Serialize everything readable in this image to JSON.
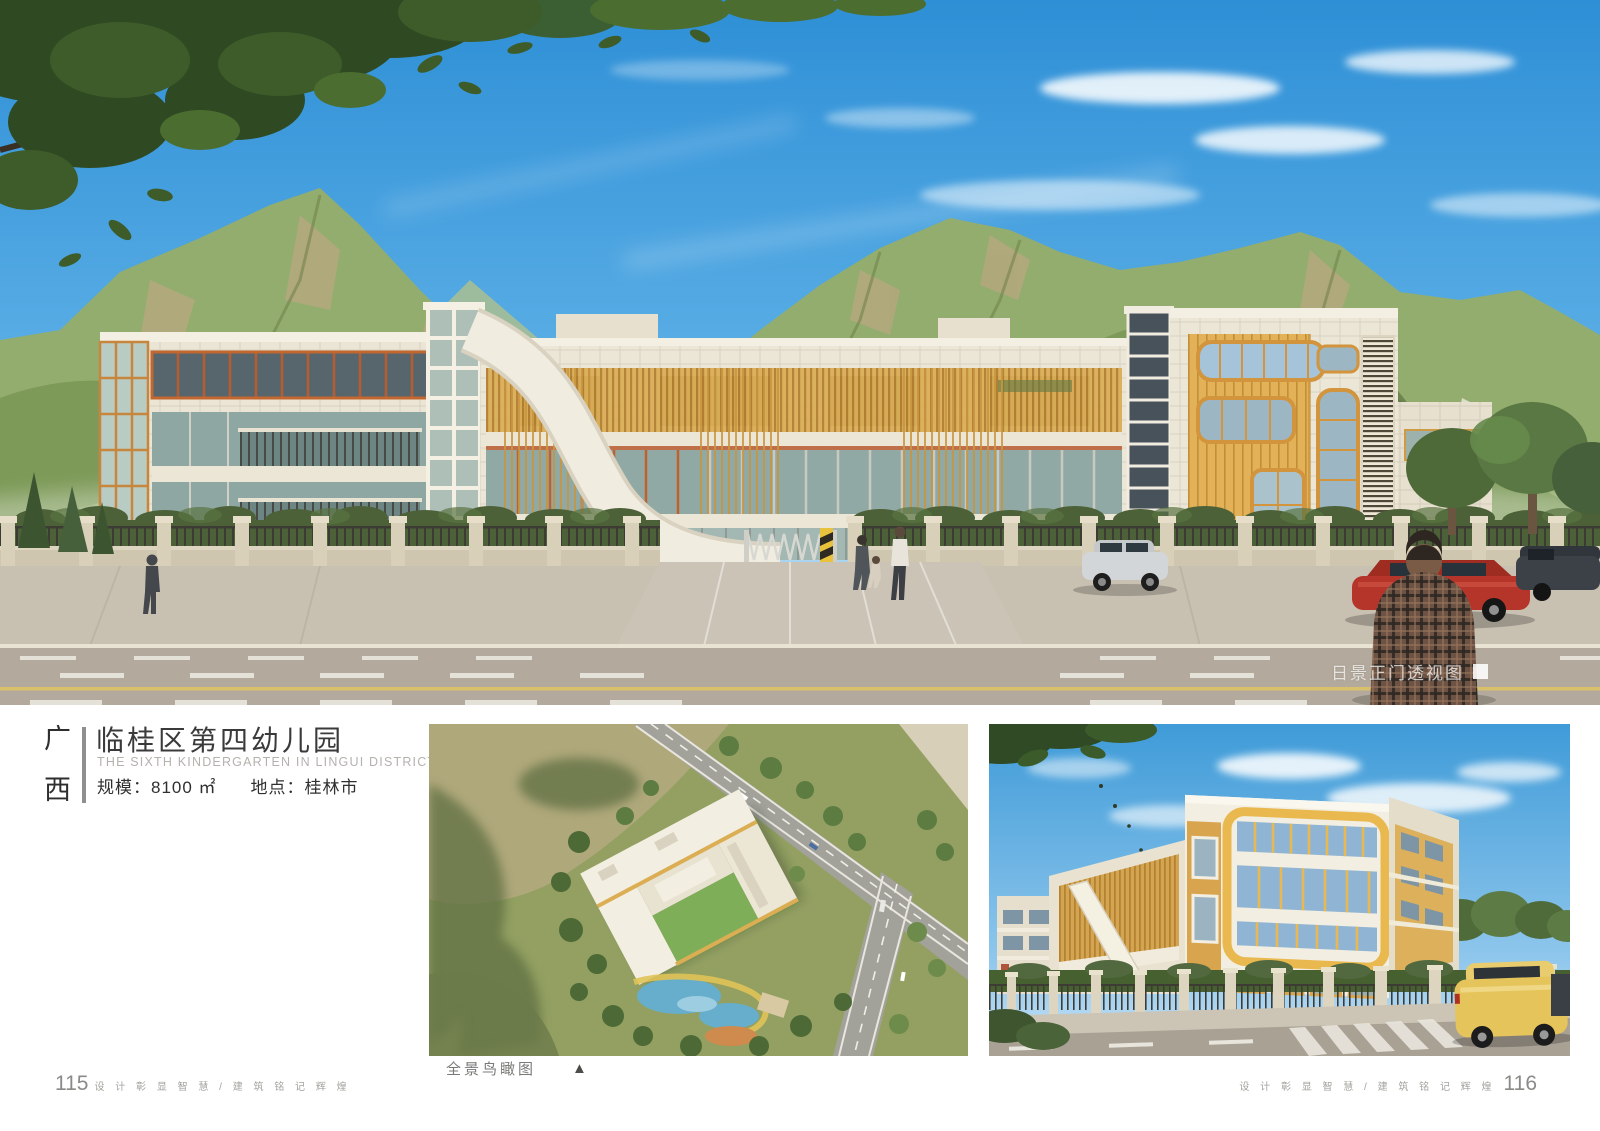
{
  "page": {
    "title_block": {
      "region_chars": [
        "广",
        "西"
      ],
      "title": "临桂区第四幼儿园",
      "subtitle_en": "THE SIXTH KINDERGARTEN IN LINGUI DISTRICT",
      "scale_label": "规模：8100 ㎡",
      "location_label": "地点：桂林市"
    },
    "hero": {
      "caption": "日景正门透视图"
    },
    "thumbnails": {
      "aerial_caption": "全景鸟瞰图",
      "aerial_marker": "▲"
    },
    "footer": {
      "left_page_number": "115",
      "right_page_number": "116",
      "slogan": "设 计 彰 显 智 慧 / 建 筑 铭 记 辉 煌"
    },
    "colors": {
      "sky_blue": "#3E9BD9",
      "facade_cream": "#ECE6D6",
      "accent_wood": "#DFAE54",
      "frame_orange": "#C05F2E",
      "mountain_green": "#85A05C"
    }
  }
}
